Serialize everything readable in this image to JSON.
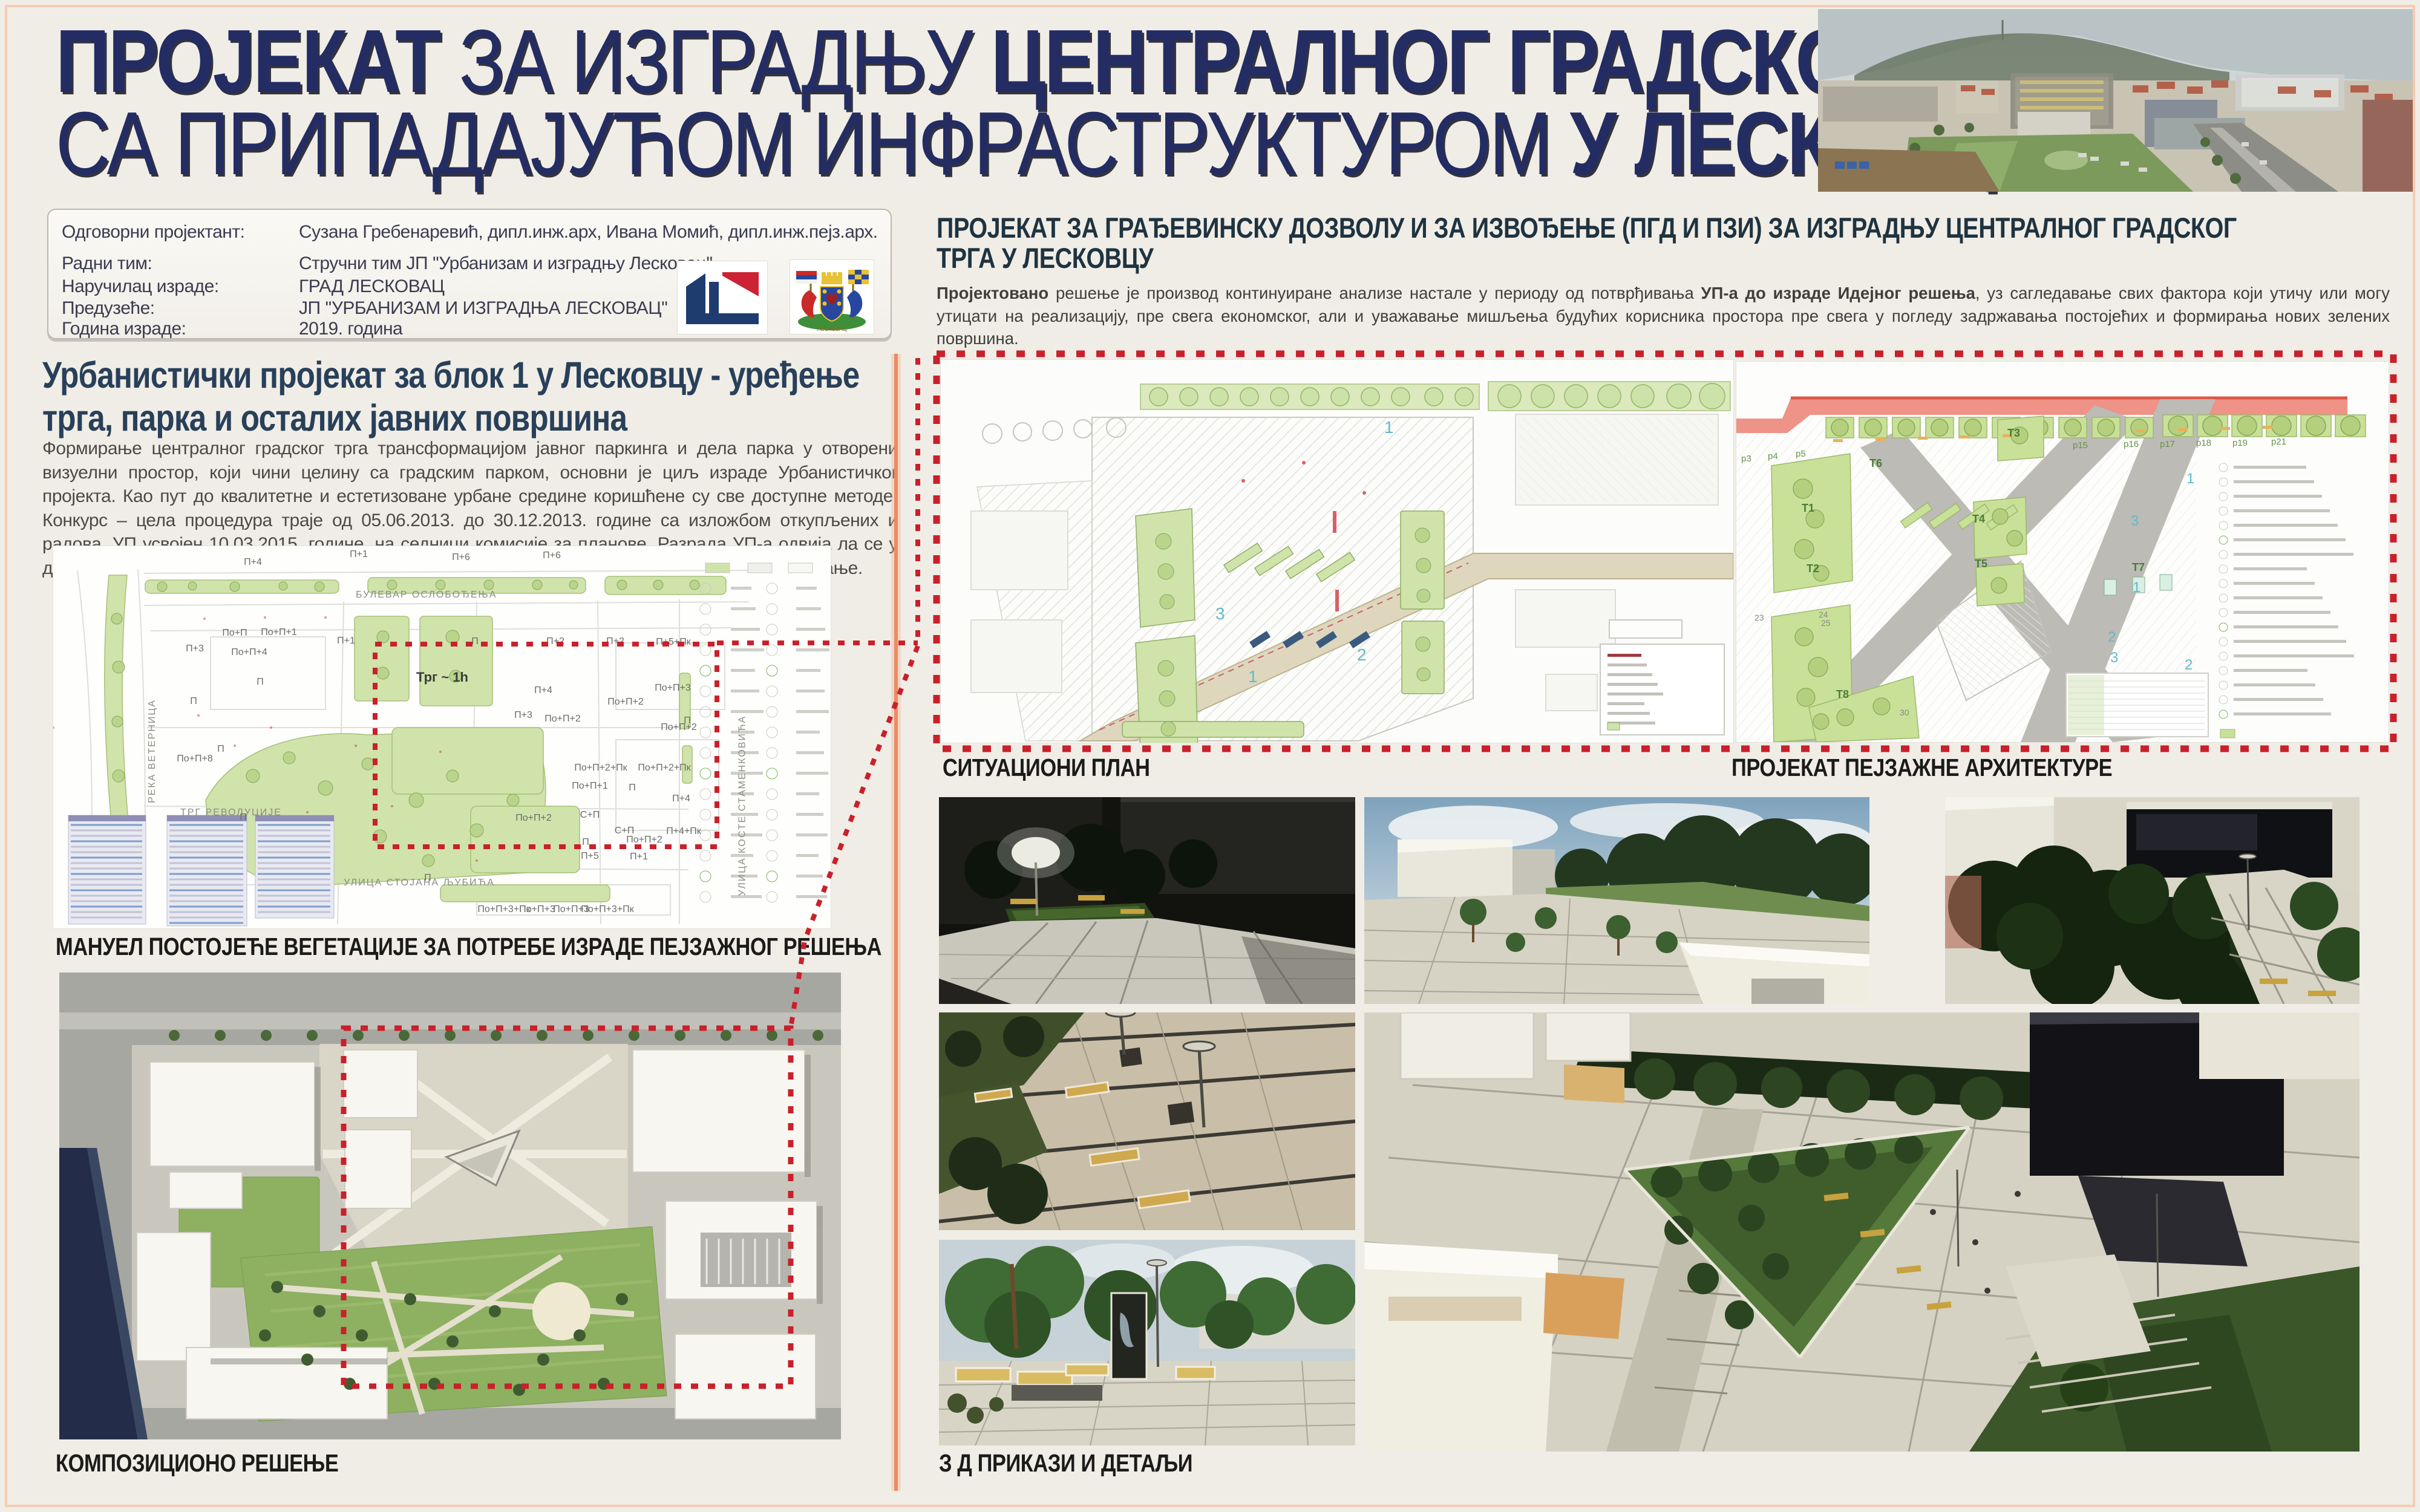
{
  "poster": {
    "title_line1": [
      {
        "text": "ПРОЈЕКАТ ",
        "bold": true
      },
      {
        "text": "ЗА ИЗГРАДЊУ ",
        "bold": false
      },
      {
        "text": "ЦЕНТРАЛНОГ ГРАДСКОГ ТРГА",
        "bold": true
      }
    ],
    "title_line2": [
      {
        "text": "СА ПРИПАДАЈУЋОМ ИНФРАСТРУКТУРОМ ",
        "bold": false
      },
      {
        "text": "У ЛЕСКОВЦУ",
        "bold": true
      }
    ]
  },
  "info_panel": {
    "rows": [
      {
        "label": "Одговорни пројектант:",
        "value": "Сузана Гребенаревић, дипл.инж.арх, Ивана Момић, дипл.инж.пејз.арх."
      },
      {
        "label": "Радни тим:",
        "value": "Стручни тим ЈП ''Урбанизам и изградњу Лесковац''"
      },
      {
        "label": "Наручилац израде:",
        "value": "ГРАД ЛЕСКОВАЦ"
      },
      {
        "label": "Предузеће:",
        "value": "ЈП ''УРБАНИЗАМ И ИЗГРАДЊА ЛЕСКОВАЦ''"
      },
      {
        "label": "Година израде:",
        "value": "2019. година"
      }
    ],
    "coat_of_arms_text": "ЛЕСКОВАЦ"
  },
  "left_section": {
    "heading_line1": "Урбанистички пројекат за блок 1 у Лесковцу - уређење",
    "heading_line2": "трга, парка и осталих јавних површина",
    "paragraph": "Формирање централног градског трга трансформацијом јавног паркинга и дела парка у отворени визуелни простор, који чини целину са градским парком, основни је циљ израде Урбанистичког пројекта. Као пут до квалитетне и естетизоване урбане средине коришћене су све доступне методе. Конкурс – цела процедура траје од 05.06.2013. до 30.12.2013. године са изложбом откупљених и радова. УП усвојен 10.03.2015. године, на седници комисије за планове. Разрада УП-а одвија ла се у две фазе: прва фаза- студија (истраживање и анализа) и друга фаза – урбанистичко пројектовање.",
    "map_caption": "МАНУЕЛ ПОСТОЈЕЋЕ ВЕГЕТАЦИЈЕ ЗА ПОТРЕБЕ ИЗРАДЕ ПЕЈЗАЖНОГ РЕШЕЊА",
    "composition_caption": "КОМПОЗИЦИОНО РЕШЕЊЕ"
  },
  "vegetation_map": {
    "street_labels": [
      "БУЛЕВАР ОСЛОБОЂЕЊА",
      "РЕКА ВЕТЕРНИЦА",
      "УЛИЦА КОСТЕ СТАМЕНКОВИЋА",
      "УЛИЦА СТОЈАНА ЉУБИЋА",
      "ТРГ РЕВОЛУЦИЈЕ"
    ],
    "square_label": "Трг ~ 1h",
    "building_labels": [
      "П+4",
      "П+1",
      "П+6",
      "П+6",
      "П+3",
      "По+П",
      "По+П+1",
      "По+П+4",
      "П+1",
      "П",
      "П+2",
      "П+2",
      "П+5+Пк",
      "П",
      "П",
      "П+4",
      "По+П+3",
      "По+П+2",
      "П+3",
      "По+П+2",
      "П",
      "По+П+2",
      "По+П+8",
      "П",
      "По+П+2+Пк",
      "По+П+2+Пк",
      "По+П+1",
      "П",
      "П+4",
      "П",
      "По+П+2",
      "С+П",
      "С+П",
      "П",
      "П+4+Пк",
      "По+П+2",
      "П+5",
      "П+1",
      "П",
      "По+П+3+Пк",
      "По+П+3",
      "По+П+3",
      "По+П+3+Пк"
    ]
  },
  "right_section": {
    "heading_line1": "ПРОЈЕКАТ ЗА ГРАЂЕВИНСКУ ДОЗВОЛУ И ЗА ИЗВОЂЕЊЕ (ПГД И ПЗИ) ЗА ИЗГРАДЊУ ЦЕНТРАЛНОГ ГРАДСКОГ",
    "heading_line2": "ТРГА У ЛЕСКОВЦУ",
    "paragraph_parts": [
      {
        "text": "Пројектовано",
        "bold": true
      },
      {
        "text": " решење је производ континуиране анализе настале у периоду од потврђивања ",
        "bold": false
      },
      {
        "text": "УП-а до израде Идејног решења",
        "bold": true
      },
      {
        "text": ", уз сагледавање свих фактора који утичу или могу утицати на реализацију, пре свега економског, али и уважавање мишљења будућих корисника простора пре свега у погледу задржавања постојећих и формирања нових зелених површина.",
        "bold": false
      }
    ],
    "situational_caption": "СИТУАЦИОНИ ПЛАН",
    "landscape_caption": "ПРОЈЕКАТ ПЕЈЗАЖНЕ АРХИТЕКТУРЕ",
    "renders_caption": "З Д  ПРИКАЗИ И ДЕТАЉИ"
  },
  "situational_plan": {
    "zone_numbers": [
      "1",
      "3",
      "2",
      "1"
    ]
  },
  "landscape_plan": {
    "area_labels": [
      "T1",
      "T2",
      "T3",
      "T4",
      "T5",
      "T6",
      "T7",
      "T8"
    ],
    "p_labels": [
      "p3",
      "p4",
      "p5",
      "p15",
      "p16",
      "p17",
      "p18",
      "p19",
      "p21"
    ],
    "zone_numbers": [
      "1",
      "3",
      "1",
      "2",
      "3",
      "2"
    ],
    "small_numbers": [
      "23",
      "24",
      "25",
      "30"
    ]
  },
  "colors": {
    "background": "#f0ede6",
    "title_navy": "#232c63",
    "heading_blue": "#28405a",
    "header_dark": "#1f3340",
    "accent_red": "#c9202b",
    "divider_salmon": "#ee8a60",
    "map_green": "#cfe3ab",
    "plan_green": "#c9e098",
    "caption_black": "#1b1b19"
  }
}
